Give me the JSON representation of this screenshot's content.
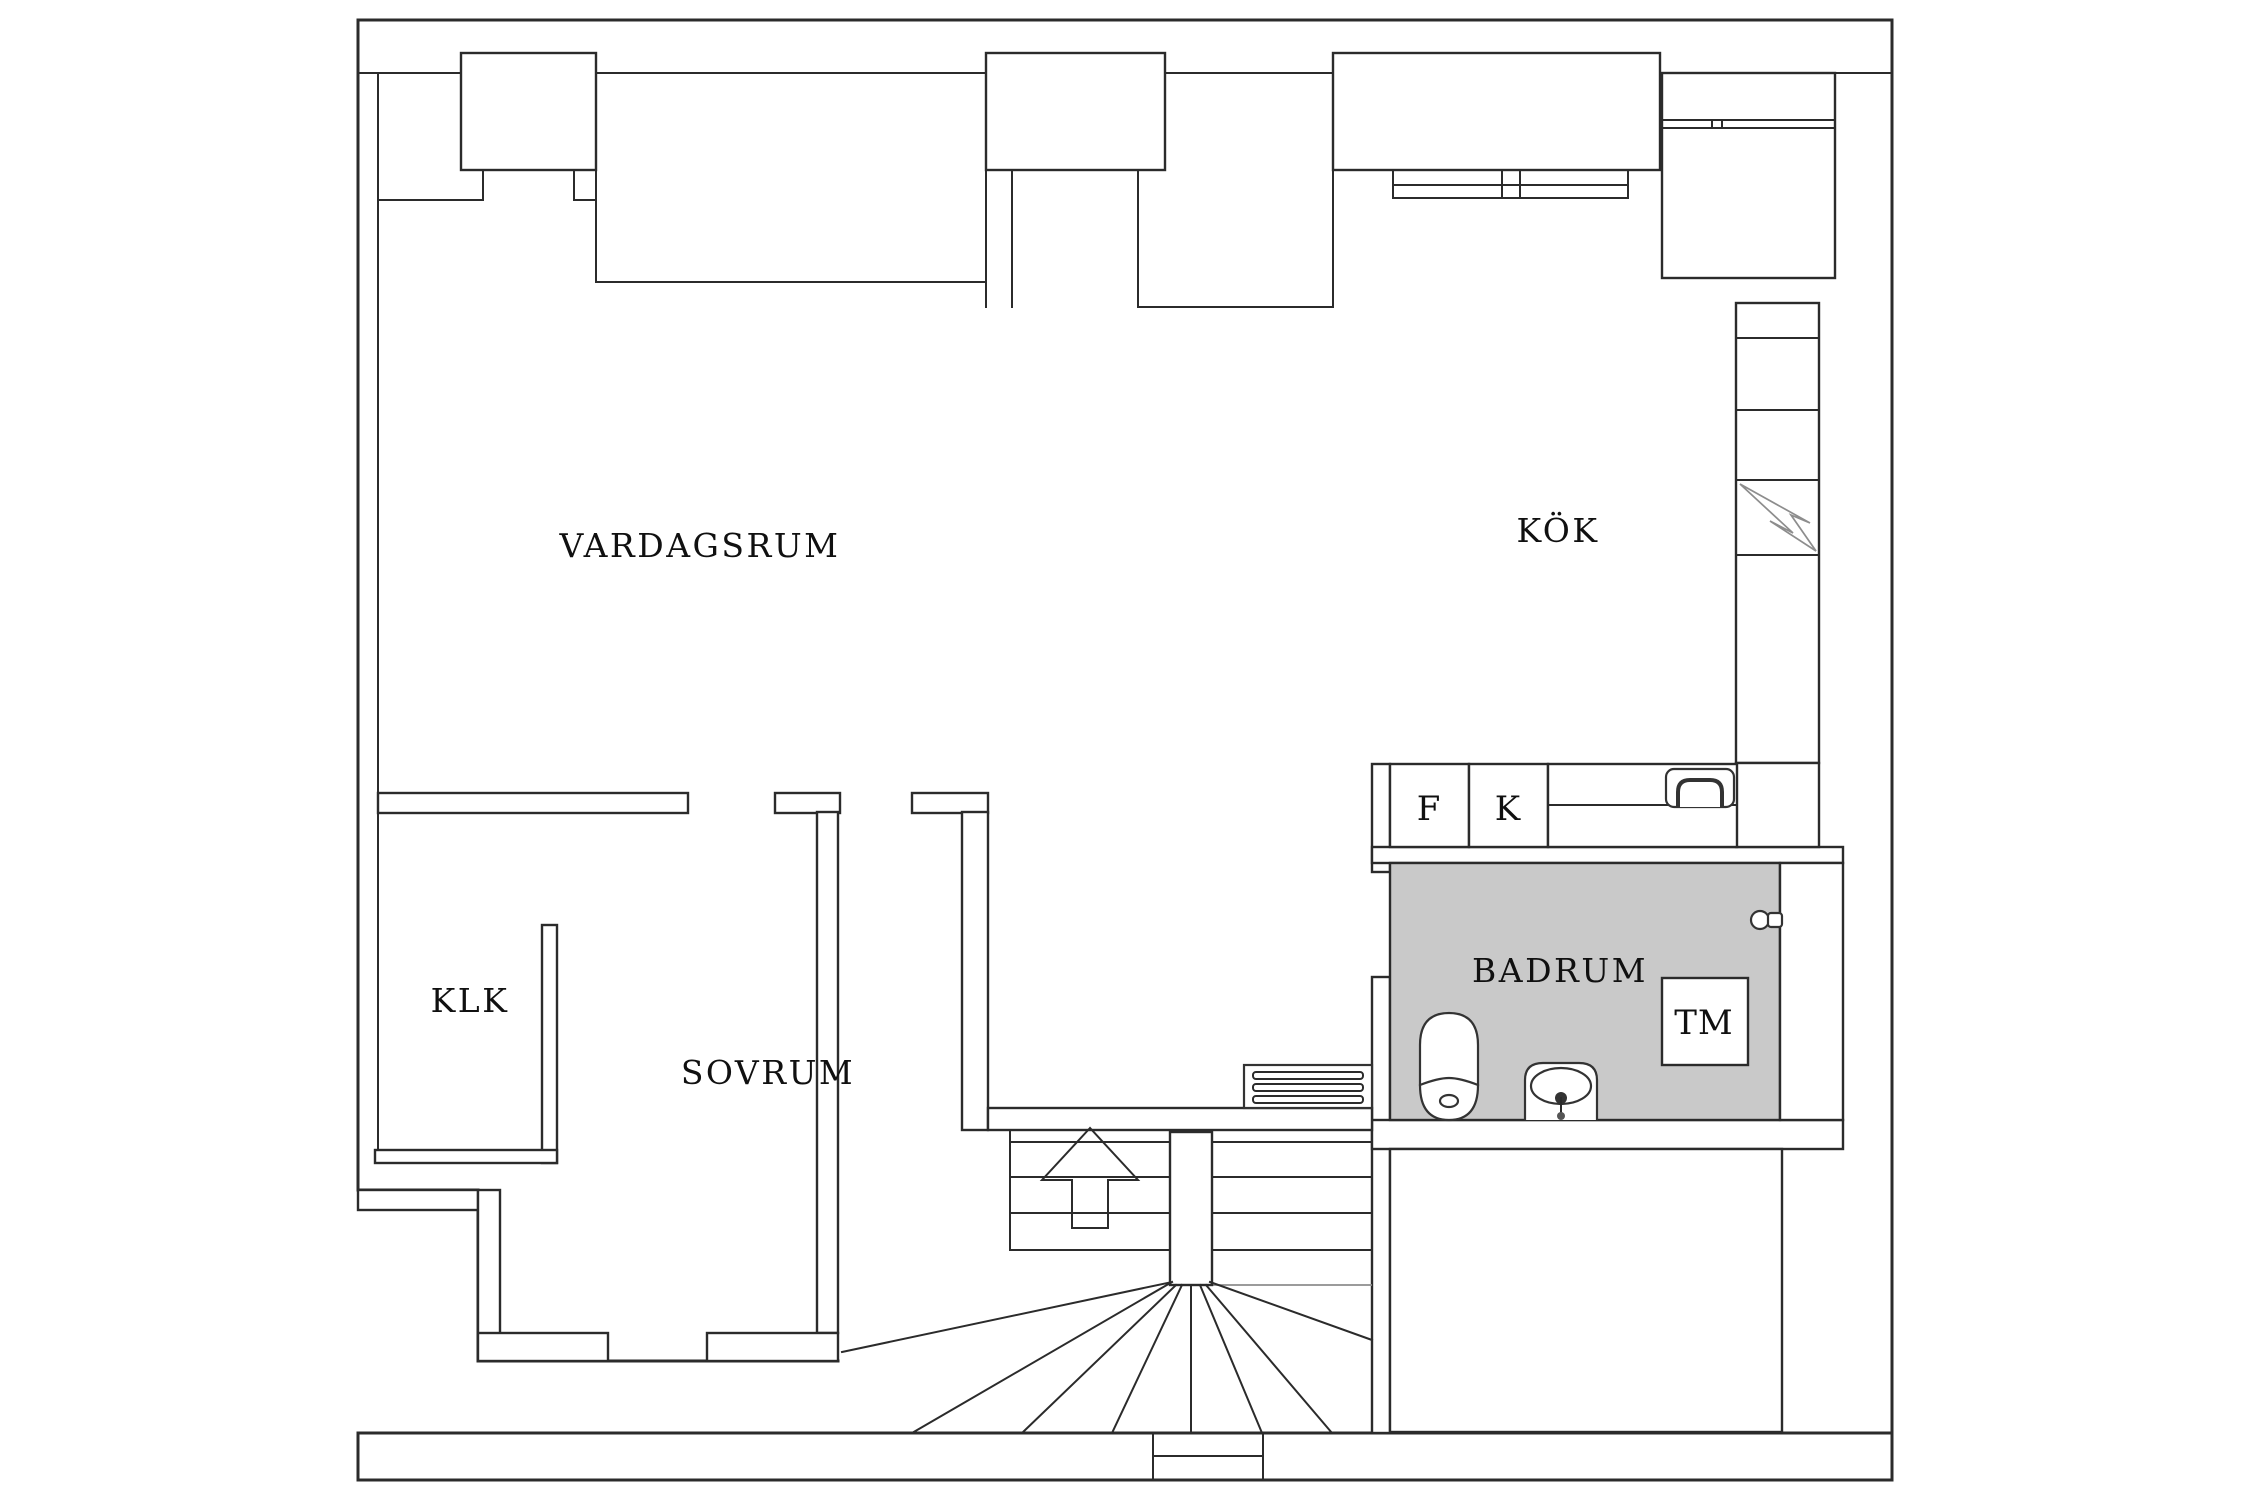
{
  "drawing": {
    "kind": "apartment floor plan",
    "floor_fill": "white",
    "bathroom_floor_shaded": true
  },
  "labels": {
    "living_room": "VARDAGSRUM",
    "kitchen": "KÖK",
    "closet": "KLK",
    "bedroom": "SOVRUM",
    "bathroom": "BADRUM",
    "washing_machine": "TM",
    "cabinet_f": "F",
    "cabinet_k": "K"
  },
  "colors": {
    "wall_line": "#2b2b2b",
    "detail_line": "#8d8d8d",
    "bathroom_floor": "#c9c9c9",
    "background": "#ffffff"
  },
  "icons": {
    "stairs_up_arrow": "up-arrow",
    "toilet": "toilet-top-view",
    "washbasin": "washbasin-top-view",
    "kitchen_sink": "kitchen-sink-top-view",
    "radiator": "radiator-slats",
    "electrical_panel": "lightning-bolt",
    "door_knob": "door-knob"
  }
}
